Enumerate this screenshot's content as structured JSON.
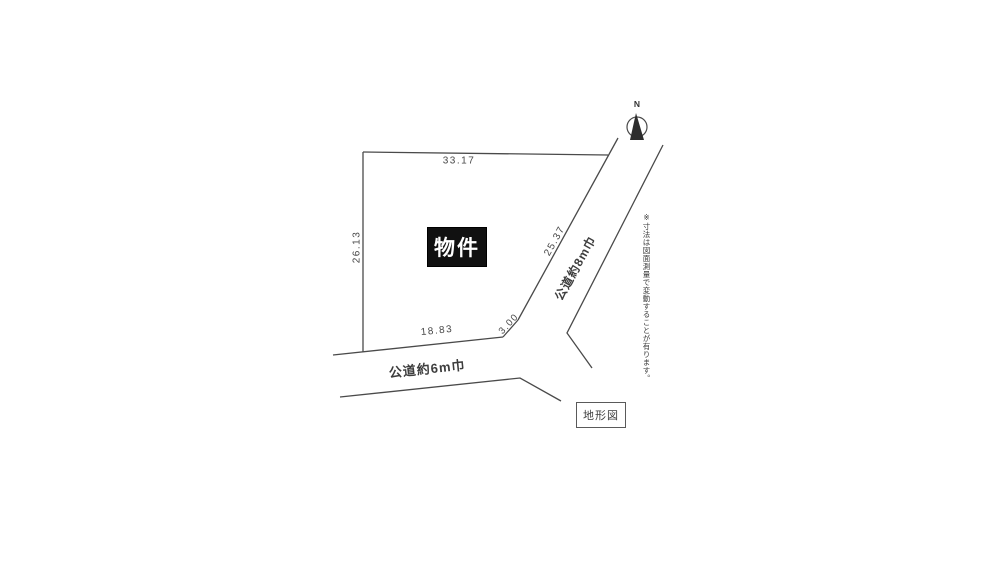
{
  "diagram": {
    "legend_title": "地形図",
    "property_label": "物件",
    "compass_label": "N",
    "dimensions": {
      "top": "33.17",
      "left": "26.13",
      "diagonal": "25.37",
      "bottom": "18.83",
      "corner_cut": "3.00"
    },
    "roads": {
      "bottom_label": "公道約6m巾",
      "diagonal_label": "公道約8m巾"
    },
    "note": "※寸法は図面測量で変動することが有ります。",
    "colors": {
      "line": "#4a4a4a",
      "property_box_bg": "#111111",
      "property_box_fg": "#ffffff",
      "background": "#ffffff"
    }
  }
}
